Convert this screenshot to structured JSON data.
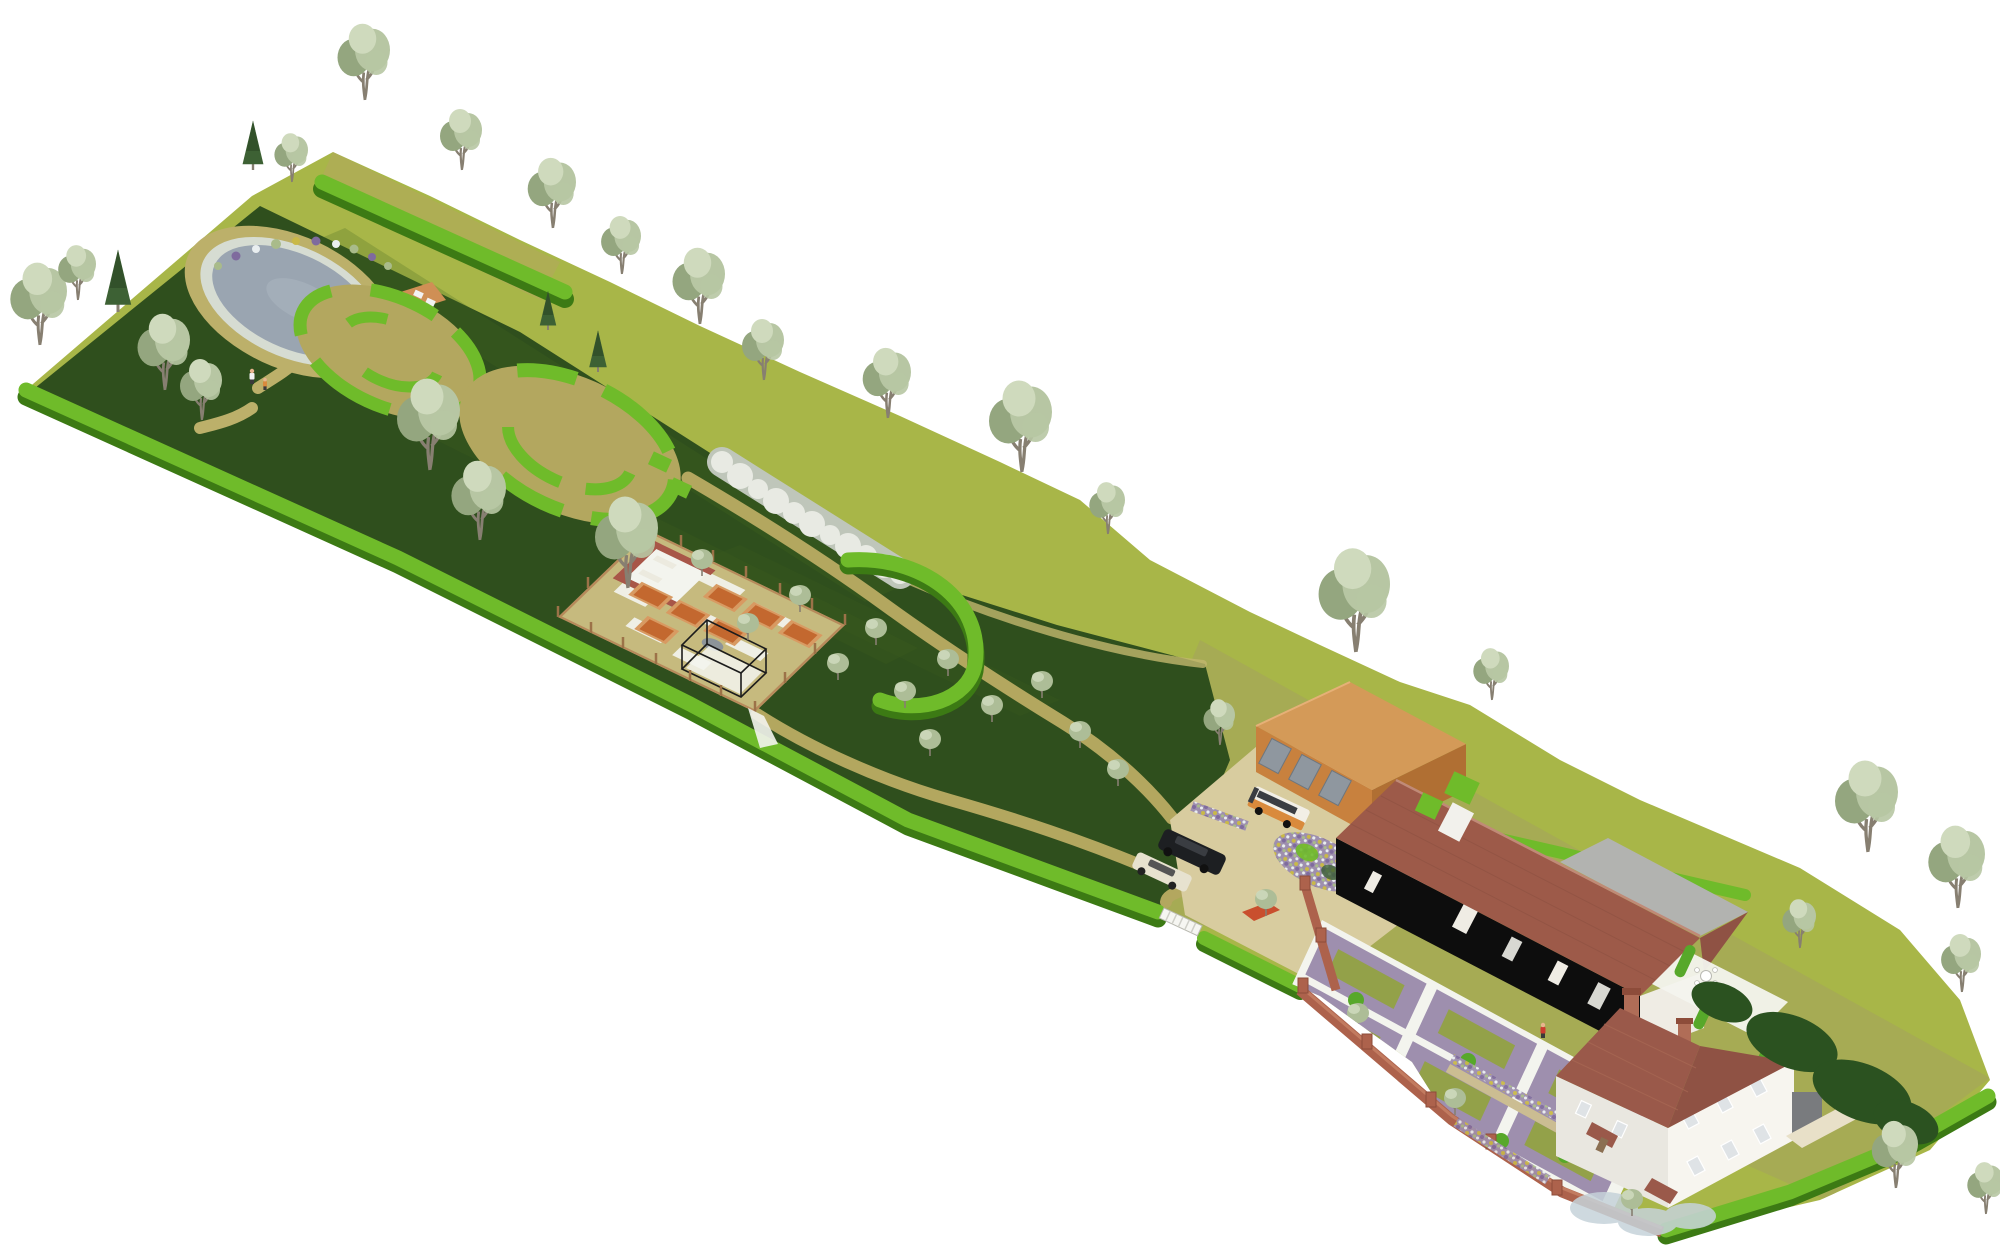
{
  "scene": {
    "title": "Isometric garden masterplan 3D render",
    "description": "Long diagonal country plot running from a wildlife pond at top-left to a farmhouse at bottom-right",
    "regions": {
      "pond_garden": "Wildlife pond with pebble beach and timber jetty",
      "circular_garden": "Circular hedge garden rooms with gravel floors",
      "kitchen_garden": "Fenced kitchen garden with raised beds, seating court, water butt and fruit cage",
      "blossom_walk": "White blossom shrub belt",
      "orchard": "Orchard and meadow with winding mown paths",
      "boundary_trees": "Boundary tree belt on grass bank",
      "driveway": "Gravel parking court with entrance gate",
      "garage": "Detached double garage",
      "barn": "Long black timber barn with clay tiled roof",
      "formal_garden": "Formal parterre of lawn panels, mixed borders and topiary",
      "house": "Rendered farmhouse with hipped tile roof and brick chimneys",
      "patio": "Rear terrace with dining table and fire bowl",
      "meadow": "Rear meadow with organic shrub beds"
    },
    "counts": {
      "raised_beds": 7,
      "lawn_panels": 6,
      "vehicles": 4,
      "people": 3,
      "topiary_balls": 8
    }
  },
  "colors": {
    "background": "#ffffff",
    "band_olive": "#a8b648",
    "meadow_olive": "#a5aa55",
    "lawn_dark": "#2f4f1d",
    "lawn_stripe": "#44661f",
    "lawn_facet": "#223c12",
    "hedge_bright": "#6fbb2a",
    "hedge_top": "#8acd3b",
    "hedge_shade": "#3c7a14",
    "path_gravel": "#b3a75f",
    "path_light": "#c2b76e",
    "path_white": "#f3f4ee",
    "pond_water": "#9aa5b1",
    "pond_pebble": "#d6dcd2",
    "pond_sand": "#bcb06a",
    "pond_glint": "#aab4be",
    "deck_wood": "#cf8f55",
    "kg_ground": "#c6ba7e",
    "bed_soil": "#c3682f",
    "bed_frame": "#d89a62",
    "seat_brick": "#a85648",
    "fence_wood": "#b7885a",
    "fence_post": "#9c7248",
    "tank_grey": "#8d9499",
    "cage_black": "#1c1c1c",
    "blossom": "#e8eae3",
    "blossom_shade": "#bfc6ba",
    "driveway": "#d8cc9f",
    "garage_wall": "#c8813e",
    "garage_wall_shade": "#b06f33",
    "garage_roof": "#d49a58",
    "garage_door": "#8f979f",
    "barn_wall": "#0d0d0d",
    "barn_roof": "#9d5a49",
    "barn_roof_line": "#8a4f40",
    "barn_ridge": "#c08a77",
    "barn_roof_rear": "#b2b3b0",
    "barn_trim": "#efece4",
    "brick_wall": "#ad624c",
    "brick_dark": "#8d4c3a",
    "brick_light": "#c27b60",
    "stone_wall": "#cbbd92",
    "panel_lawn": "#93a149",
    "flower_base": "#9e8fae",
    "flower_gold": "#c9b948",
    "flower_plum": "#7f6b9e",
    "flower_white": "#e9eef0",
    "flower_sage": "#a9bb8a",
    "topiary": "#57a82a",
    "house_wall": "#e9e7e0",
    "house_wall_light": "#f7f5ef",
    "house_roof": "#9a594a",
    "house_roof_shade": "#8f5244",
    "house_roof_line": "#aa6a55",
    "chimney": "#b06d57",
    "window_glass": "#dfe3e6",
    "window_frame": "#8b8f94",
    "grey_box": "#797b7e",
    "tree_canopy": "#b7c6a3",
    "tree_light": "#cfdabd",
    "tree_dark": "#94a67f",
    "trunk": "#877f71",
    "conifer_dark": "#3d6134",
    "conifer_deep": "#2f4e28",
    "orchard_canopy": "#adbd97",
    "shrub_dark": "#2b5220",
    "shrub_mist": "#c6d3da",
    "car_black": "#1d1f22",
    "car_glass": "#3a3d42",
    "car_cream": "#e7e2cf",
    "camper_white": "#f2efe6",
    "camper_orange": "#d98a3c",
    "car_red": "#c94f2e",
    "person_skin": "#e8b48e",
    "person_red": "#cc3b2f",
    "person_white": "#f2f2f2",
    "person_dark": "#3a3a3a"
  }
}
